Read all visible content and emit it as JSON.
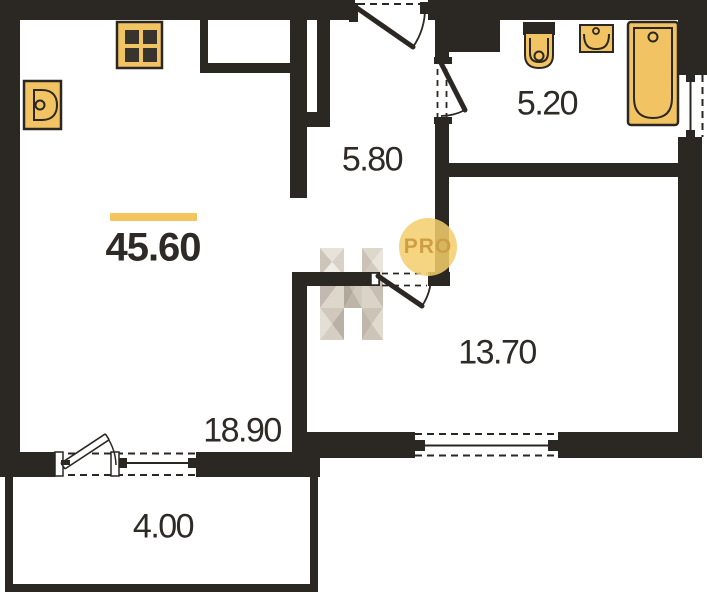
{
  "plan": {
    "total_area": "45.60",
    "rooms": [
      {
        "name": "hallway",
        "area": "5.80"
      },
      {
        "name": "bathroom",
        "area": "5.20"
      },
      {
        "name": "bedroom",
        "area": "13.70"
      },
      {
        "name": "kitchen-living-room",
        "area": "18.90"
      },
      {
        "name": "balcony",
        "area": "4.00"
      }
    ],
    "watermark": {
      "badge_text": "PRO",
      "logo": "faceted-letter-h"
    },
    "fixtures": [
      "stove",
      "kitchen-sink",
      "toilet",
      "washbasin",
      "bathtub"
    ],
    "colors": {
      "wall": "#2b2723",
      "fixture_fill": "#f2c362",
      "fixture_stroke": "#2b2723",
      "accent_line": "#f4c45f",
      "badge_bg": "#f3ce6c",
      "badge_text": "#cd9f45",
      "label_text": "#2e2a25",
      "watermark_tan": "#cdc5b8"
    }
  }
}
